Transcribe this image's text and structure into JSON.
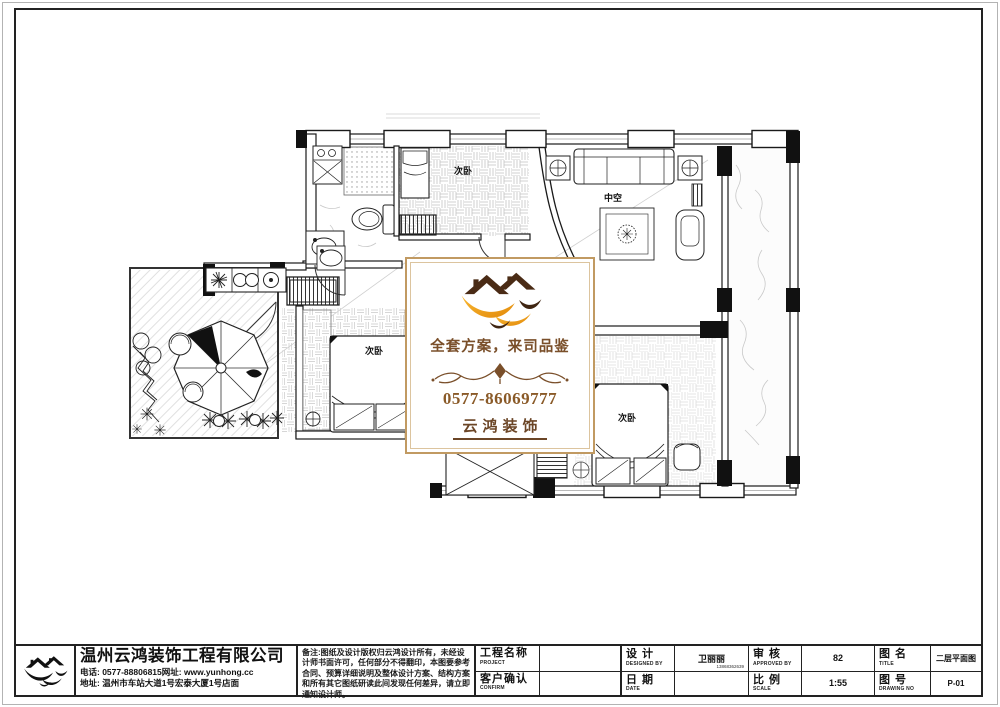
{
  "watermark": {
    "slogan": "全套方案，来司品鉴",
    "phone": "0577-86069777",
    "brand": "云鸿装饰"
  },
  "company": {
    "name": "温州云鸿装饰工程有限公司",
    "phone_line": "电话: 0577-88806815网址: www.yunhong.cc",
    "address_line": "地址: 温州市车站大道1号宏泰大厦1号店面"
  },
  "title_block": {
    "notes": "备注:图纸及设计版权归云鸿设计所有，未经设计师书面许可，任何部分不得翻印，本图要参考合同、预算详细说明及整体设计方案、结构方案和所有其它图纸研读此间发现任何差异，请立即通知设计师。",
    "project": {
      "label": "工程名称",
      "sub": "PROJECT",
      "value": ""
    },
    "confirm": {
      "label": "客户确认",
      "sub": "CONFIRM",
      "value": ""
    },
    "designed": {
      "label": "设 计",
      "sub": "DESIGNED BY",
      "value": "卫丽丽",
      "note": "13868362639"
    },
    "approved": {
      "label": "审 核",
      "sub": "APPROVED BY",
      "value": "82"
    },
    "date": {
      "label": "日 期",
      "sub": "DATE",
      "value": ""
    },
    "scale": {
      "label": "比 例",
      "sub": "SCALE",
      "value": "1:55"
    },
    "drawing_title": {
      "label": "图 名",
      "sub": "TITLE",
      "value": "二层平面图"
    },
    "drawing_no": {
      "label": "图 号",
      "sub": "DRAWING NO",
      "value": "P-01"
    }
  },
  "plan": {
    "rooms": [
      {
        "id": "bedroom-top",
        "label": "次卧"
      },
      {
        "id": "living-void",
        "label": "中空"
      },
      {
        "id": "bedroom-left",
        "label": "次卧"
      },
      {
        "id": "bedroom-bottom",
        "label": "次卧"
      }
    ]
  },
  "colors": {
    "brand_gold": "#efa21d",
    "brand_brown": "#4a2b15",
    "card_border": "#c19a62"
  }
}
